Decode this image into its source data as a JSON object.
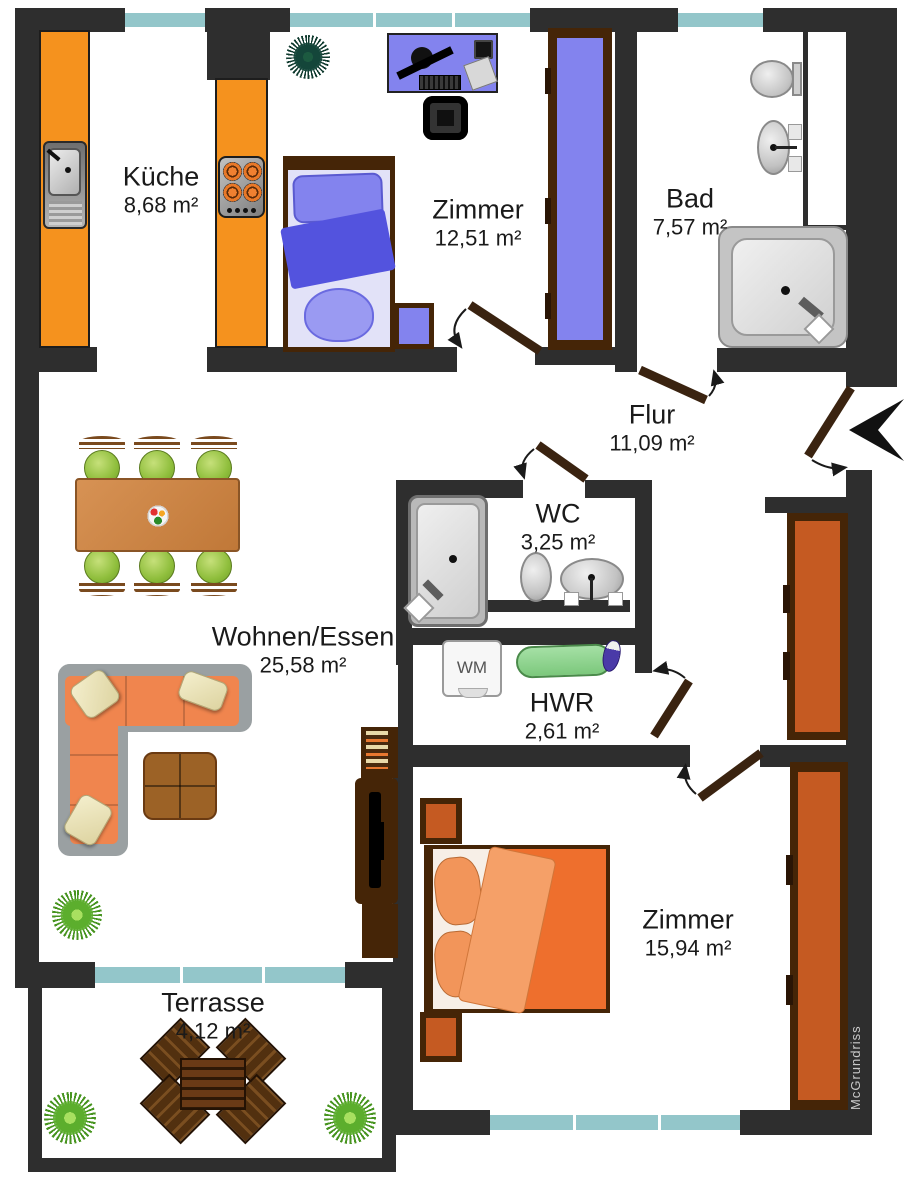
{
  "title": "Wohnungsgrundriss",
  "rooms": [
    {
      "id": "kueche",
      "name": "Küche",
      "area": "8,68 m²"
    },
    {
      "id": "zimmer1",
      "name": "Zimmer",
      "area": "12,51 m²"
    },
    {
      "id": "bad",
      "name": "Bad",
      "area": "7,57 m²"
    },
    {
      "id": "flur",
      "name": "Flur",
      "area": "11,09 m²"
    },
    {
      "id": "wc",
      "name": "WC",
      "area": "3,25 m²"
    },
    {
      "id": "wohnen",
      "name": "Wohnen/Essen",
      "area": "25,58 m²"
    },
    {
      "id": "hwr",
      "name": "HWR",
      "area": "2,61 m²"
    },
    {
      "id": "zimmer2",
      "name": "Zimmer",
      "area": "15,94 m²"
    },
    {
      "id": "terrasse",
      "name": "Terrasse",
      "area": "4,12 m²"
    }
  ],
  "labels": {
    "washing_machine": "WM",
    "watermark": "McGrundriss"
  },
  "colors": {
    "wall": "#2e2e2e",
    "window": "#93c6ca",
    "counter": "#f5921e",
    "frame": "#452507",
    "rust": "#c55a22",
    "blue": "#8383ee",
    "blueDark": "#5353de",
    "blueLight": "#e2e2f8",
    "bedOrange": "#ee6f2d",
    "bedFlap": "#f5a068",
    "sofa": "#f0854e",
    "sofaBack": "#9aa0a2",
    "tableWood": "#cd8745",
    "chairGreen": "#8fbe3c",
    "coffee": "#9c6226",
    "ironing": "#8ed88e",
    "door": "#3a2310",
    "terrasseWood": "#5a3414",
    "text": "#1a1a1a",
    "watermark": "#c9c9c9"
  }
}
